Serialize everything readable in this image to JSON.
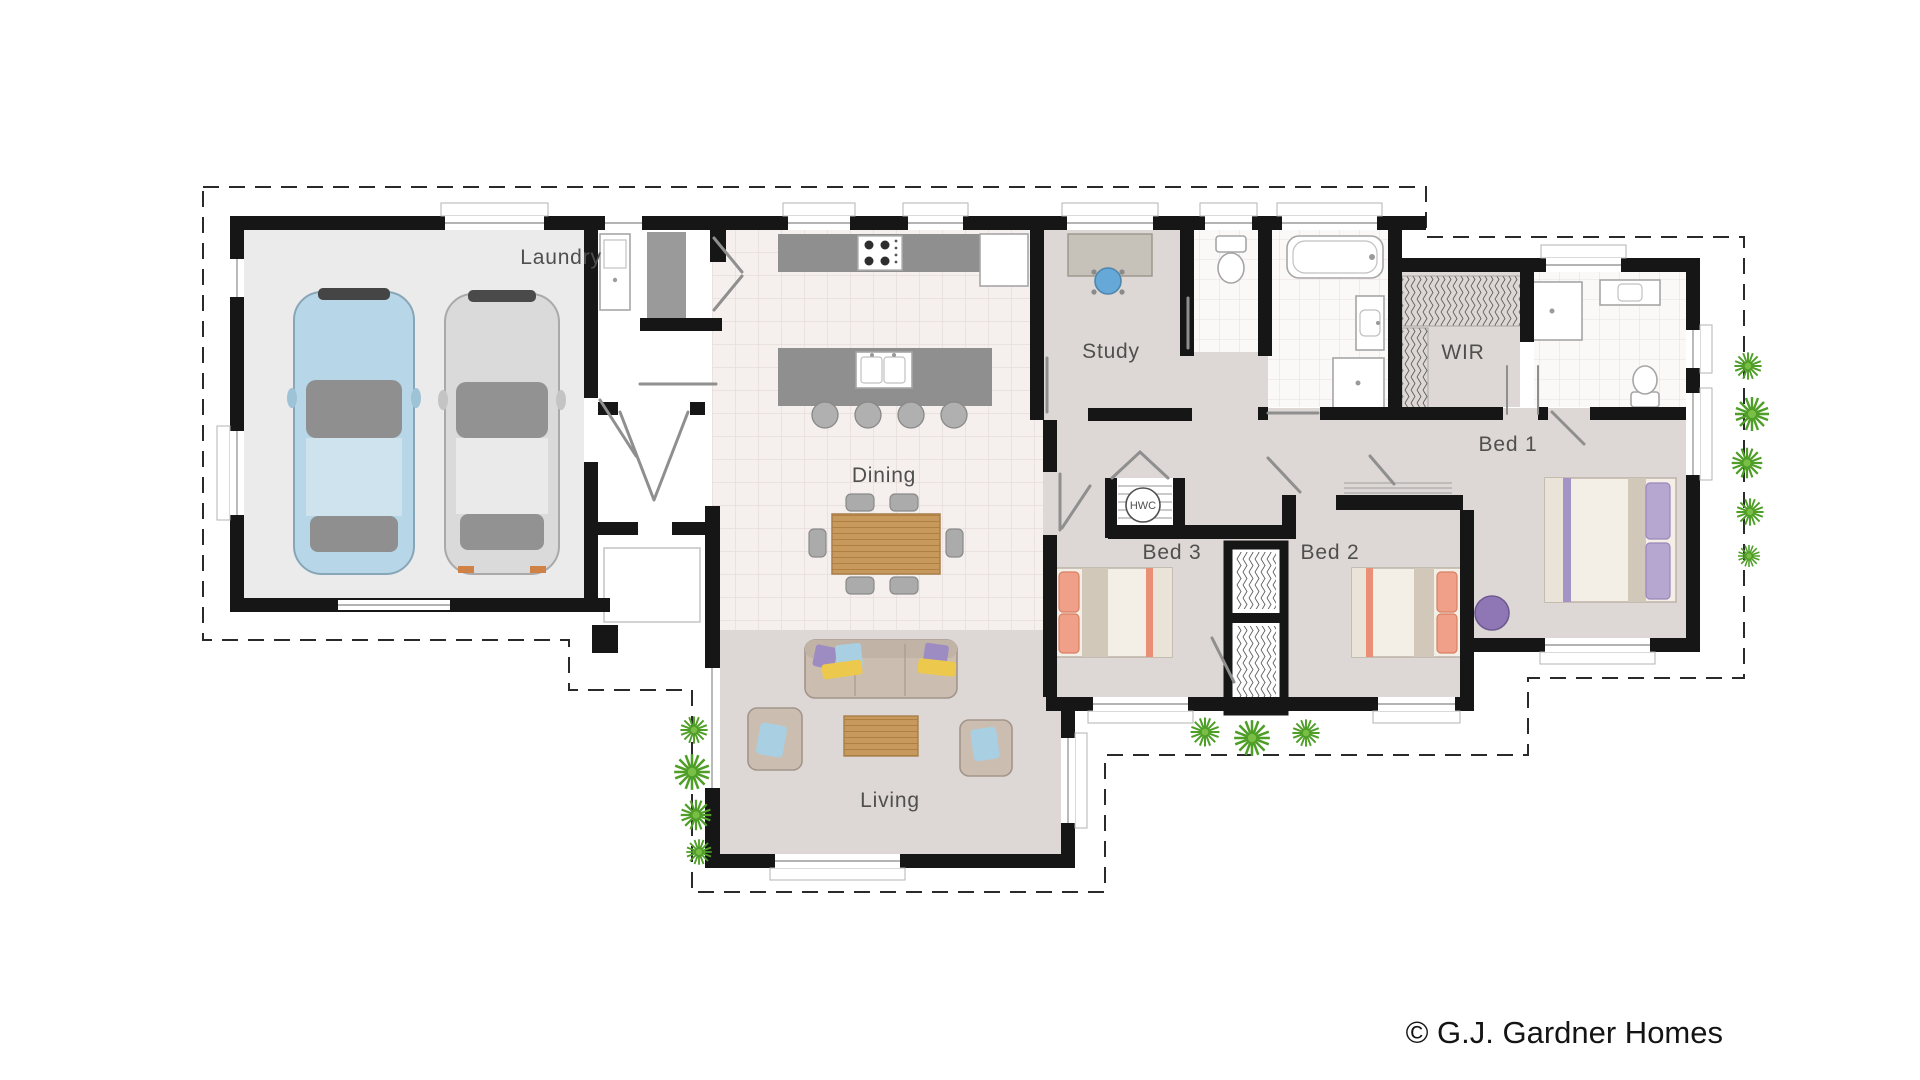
{
  "plan": {
    "labels": {
      "laundry": "Laundry",
      "dining": "Dining",
      "living": "Living",
      "study": "Study",
      "wir": "WIR",
      "bed1": "Bed 1",
      "bed2": "Bed 2",
      "bed3": "Bed 3",
      "hwc": "HWC"
    },
    "copyright": "© G.J. Gardner Homes",
    "colors": {
      "wall": "#161616",
      "tile_kitchen": "#f5efee",
      "tile_bath": "#fbf8f8",
      "floor_dark": "#ddd8d5",
      "floor_garage": "#ebebeb",
      "bench_gray": "#8f8f8f",
      "wood": "#c8995c",
      "car_blue": "#b7d7e8",
      "car_silver": "#dadada",
      "sofa_beige": "#cbbeb1",
      "bed_orange": "#f0a088",
      "bed_purple": "#b6a7d0",
      "pillow_blue": "#a9cfe2",
      "pillow_yellow": "#ecc84d",
      "plant_green": "#4e9e27",
      "label_text": "#4f4f4f"
    }
  }
}
